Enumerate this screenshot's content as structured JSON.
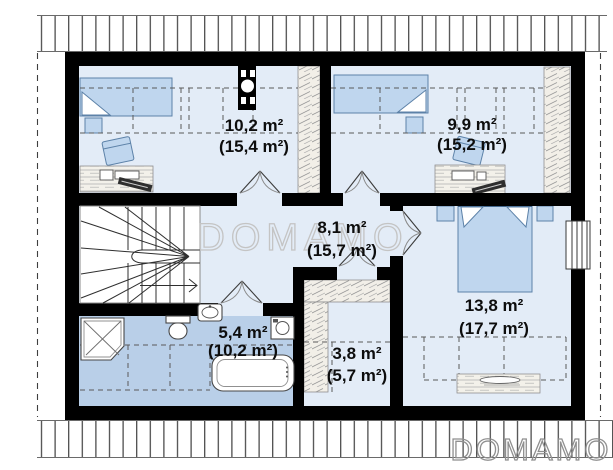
{
  "watermark": {
    "center": "DOMAMO",
    "bottom_right": "DOMAMO"
  },
  "rooms": [
    {
      "name": "bedroom-top-left",
      "area": "10,2 m²",
      "total": "(15,4 m²)"
    },
    {
      "name": "bedroom-top-right",
      "area": "9,9 m²",
      "total": "(15,2 m²)"
    },
    {
      "name": "hall",
      "area": "8,1 m²",
      "total": "(15,7 m²)"
    },
    {
      "name": "bedroom-right",
      "area": "13,8 m²",
      "total": "(17,7 m²)"
    },
    {
      "name": "bathroom",
      "area": "5,4 m²",
      "total": "(10,2 m²)"
    },
    {
      "name": "wardrobe",
      "area": "3,8 m²",
      "total": "(5,7 m²)"
    }
  ],
  "colors": {
    "wall": "#000000",
    "room_floor": "#e3ecf7",
    "bathroom_floor": "#b9cfe8",
    "furniture_fill": "#bfd6ee",
    "furniture_stroke": "#5d82a8",
    "wood_fill": "#f2efe8",
    "watermark_outline": "#c4c4c4",
    "label": "#0d0d0d"
  }
}
